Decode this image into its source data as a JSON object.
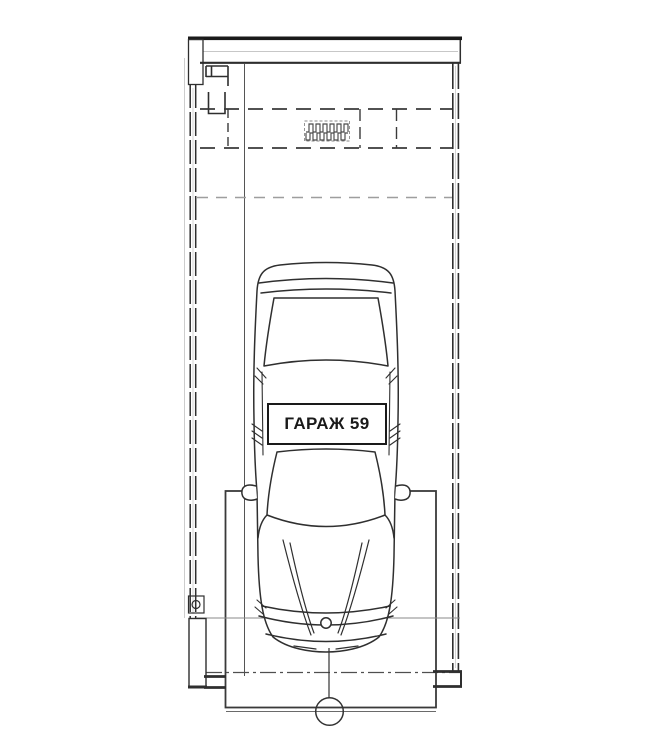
{
  "label": {
    "text": "ГАРАЖ 59"
  },
  "colors": {
    "paper": "#ffffff",
    "ink": "#2e2e2e",
    "ink_dark": "#1a1a1a",
    "faint": "#9a9a9a"
  },
  "plan": {
    "parts": [
      "top-wall-hatched",
      "left-boundary-wall-dashed",
      "right-boundary-wall-dashed",
      "left-pier-crosshatched",
      "overhead-door-dashed-zone",
      "heater-coil-symbol",
      "clearance-dashed-line",
      "car-top-view",
      "parking-apron-rectangle",
      "front-wall-line",
      "center-axis-dash-dot-line",
      "axis-marker-circle",
      "garage-number-label"
    ]
  }
}
